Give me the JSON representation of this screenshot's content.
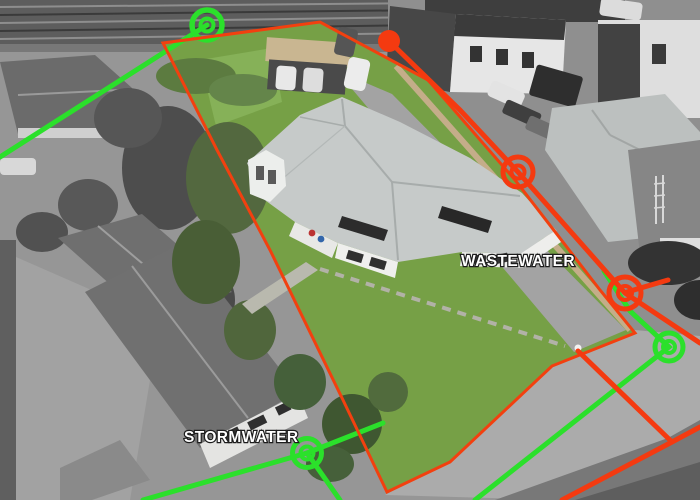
{
  "scene": {
    "description": "Aerial photograph of a residential section with drainage services overlay",
    "wastewater": {
      "label": "WASTEWATER",
      "color": "#F43A10",
      "manhole_count": 2,
      "origin_dot_count": 1
    },
    "stormwater": {
      "label": "STORMWATER",
      "color": "#2BE02B",
      "manhole_count": 3
    },
    "boundary": {
      "color": "#F2400F"
    },
    "label_text_color": "#FFFFFF"
  }
}
